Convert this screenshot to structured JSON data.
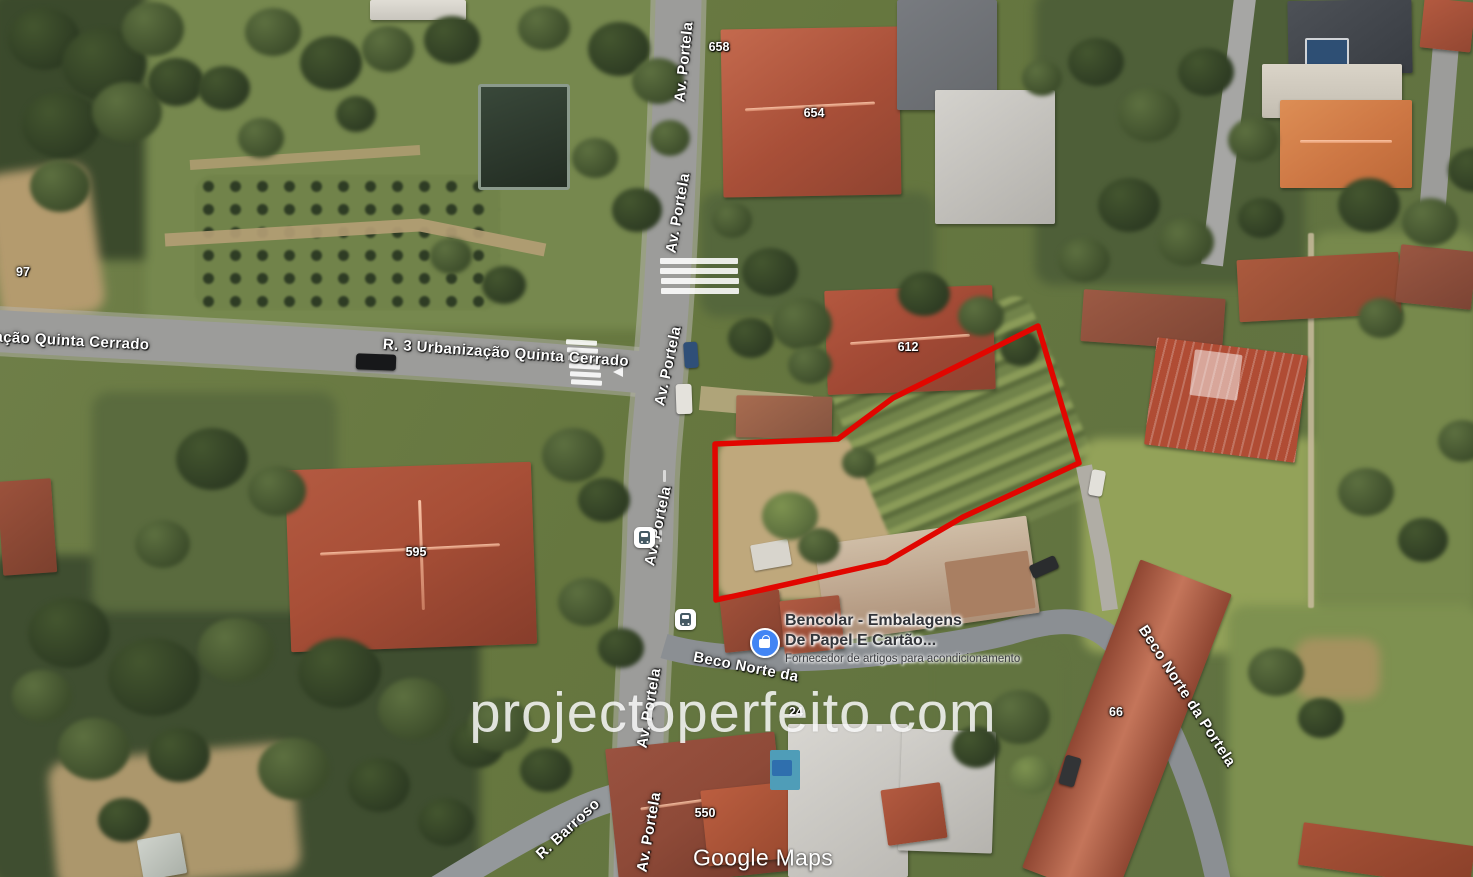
{
  "watermark": {
    "text": "projectoperfeito.com"
  },
  "attribution": {
    "text": "Google Maps"
  },
  "streets": {
    "av_portela": "Av. Portela",
    "r3": "R. 3 Urbanização Quinta Cerrado",
    "r3_clipped": "ação Quinta Cerrado",
    "beco_norte_clipped": "Beco Norte da",
    "beco_norte": "Beco Norte da Portela",
    "barroso": "R. Barroso"
  },
  "numbers": {
    "n97": "97",
    "n658": "658",
    "n654": "654",
    "n612": "612",
    "n595": "595",
    "n66": "66",
    "n550": "550",
    "n24": "24"
  },
  "poi": {
    "title_line1": "Bencolar - Embalagens",
    "title_line2": "De Papel E Cartão...",
    "subtitle": "Fornecedor de artigos para acondicionamento",
    "icon_color": "#4285f4"
  },
  "parcel": {
    "outline_color": "#e10600",
    "points": "715,444 838,439 893,398 1038,326 1079,463 963,517 886,562 757,591 716,600"
  },
  "colors": {
    "road": "#9c9c9a",
    "lane": "#8b8f93",
    "roof_red": "#a94f38",
    "field_green": "#7d8f55",
    "forest_green": "#3b4a2c",
    "dirt_tan": "#b49b6e"
  }
}
